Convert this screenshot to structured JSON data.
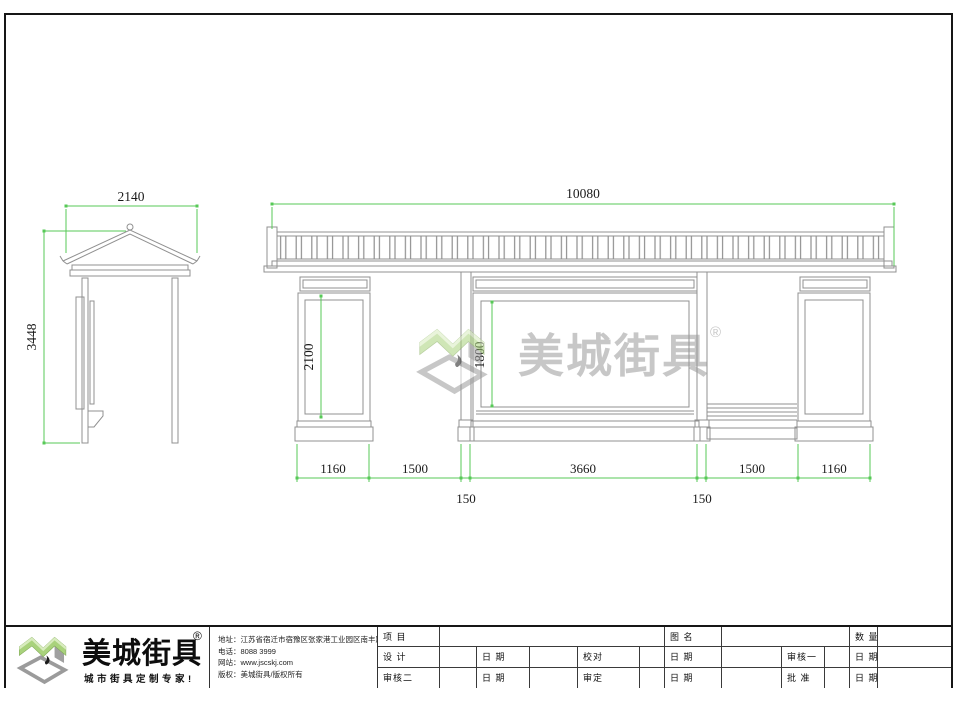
{
  "watermark": {
    "brand": "美城街具",
    "reg": "®"
  },
  "dims": {
    "side_width": "2140",
    "side_height": "3448",
    "front_total_width": "10080",
    "left_panel_height": "2100",
    "center_panel_height": "1800",
    "pillar_left_width": "1160",
    "left_bay_width": "1500",
    "center_panel_width": "3660",
    "right_bay_width": "1500",
    "pillar_right_width": "1160",
    "post_left_width": "150",
    "post_right_width": "150"
  },
  "title_block": {
    "brand": "美城街具",
    "reg": "®",
    "slogan": "城市街具定制专家!",
    "contact": {
      "address": "地址：江苏省宿迁市宿豫区张家港工业园区南丰路南侧1号",
      "phone": "电话：8088 3999",
      "website": "网站：www.jscskj.com",
      "copyright": "版权：美城街具/版权所有"
    },
    "table": {
      "project_label": "项 目",
      "drawing_name_label": "图 名",
      "quantity_label": "数 量",
      "design_label": "设 计",
      "date_label": "日 期",
      "check_label": "校对",
      "review1_label": "审核一",
      "review2_label": "审核二",
      "approve_label": "审定",
      "ratify_label": "批 准"
    }
  },
  "colors": {
    "dimension_green": "#57c957",
    "line_gray": "#909090",
    "logo_green": "#a9d27c",
    "logo_gray": "#9b9b9b"
  }
}
